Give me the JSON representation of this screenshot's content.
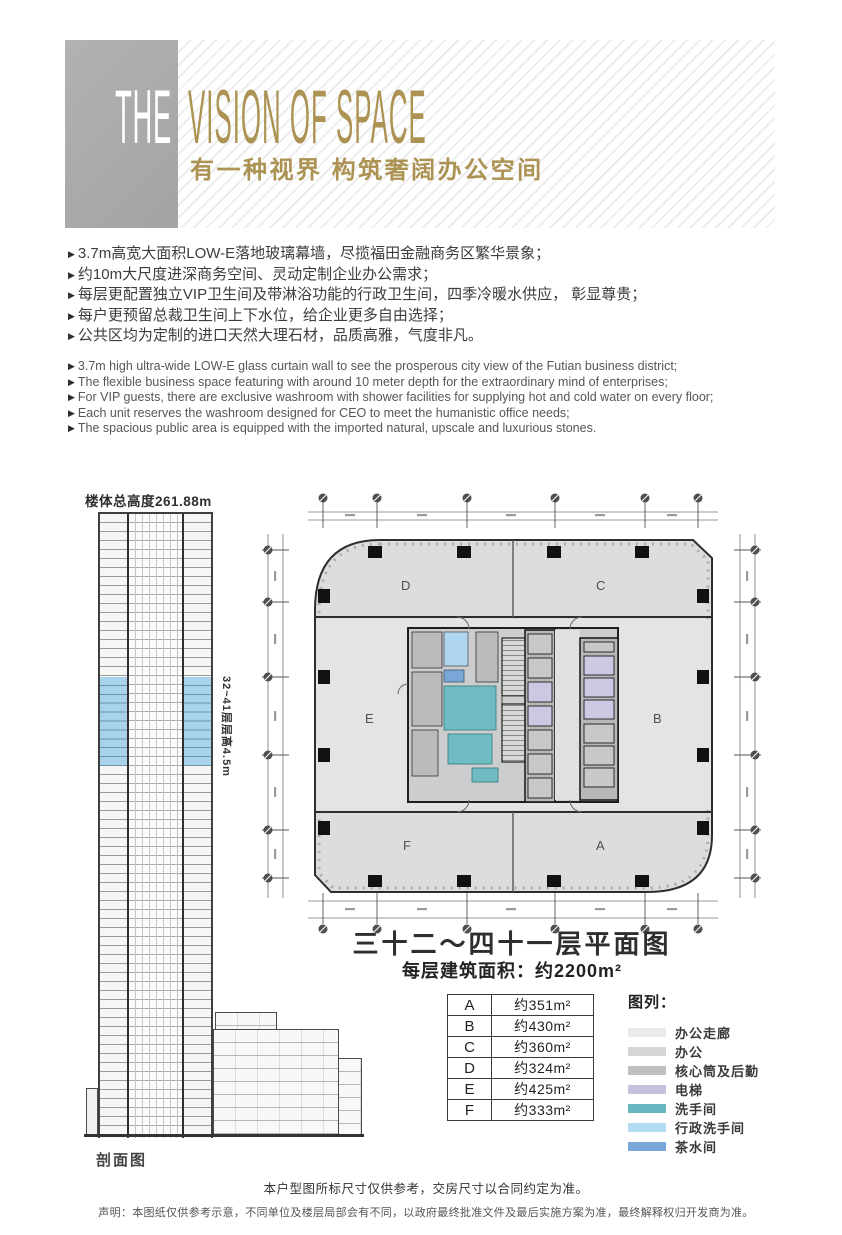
{
  "header": {
    "word_the": "THE",
    "title_en": "VISION OF SPACE",
    "subtitle_cn": "有一种视界 构筑奢阔办公空间",
    "gold_color": "#ac9353"
  },
  "bullets": {
    "glyph": "▶"
  },
  "features_cn": [
    "3.7m高宽大面积LOW-E落地玻璃幕墙，尽揽福田金融商务区繁华景象；",
    "约10m大尺度进深商务空间、灵动定制企业办公需求；",
    "每层更配置独立VIP卫生间及带淋浴功能的行政卫生间，四季冷暖水供应， 彰显尊贵；",
    "每户更预留总裁卫生间上下水位，给企业更多自由选择；",
    "公共区均为定制的进口天然大理石材，品质高雅，气度非凡。"
  ],
  "features_en": [
    "3.7m high ultra-wide LOW-E glass curtain wall to see the prosperous city view of the Futian business district;",
    "The flexible business space featuring with around 10 meter depth for the extraordinary mind of enterprises;",
    "For VIP guests, there are exclusive washroom with shower facilities for supplying hot and cold water on every floor;",
    "Each unit reserves the washroom designed for CEO to meet the humanistic office needs;",
    "The spacious public area is equipped with the imported natural, upscale and luxurious stones."
  ],
  "section_view": {
    "total_height_label": "楼体总高度261.88m",
    "floors_note": "32~41层层高4.5m",
    "caption": "剖面图",
    "highlight_color": "#a9d2ec"
  },
  "floor_plan": {
    "title": "三十二～四十一层平面图",
    "area_per_floor": "每层建筑面积：约2200m²",
    "zone_labels": {
      "A": "A",
      "B": "B",
      "C": "C",
      "D": "D",
      "E": "E",
      "F": "F"
    }
  },
  "area_table": {
    "rows": [
      {
        "zone": "A",
        "area": "约351m²"
      },
      {
        "zone": "B",
        "area": "约430m²"
      },
      {
        "zone": "C",
        "area": "约360m²"
      },
      {
        "zone": "D",
        "area": "约324m²"
      },
      {
        "zone": "E",
        "area": "约425m²"
      },
      {
        "zone": "F",
        "area": "约333m²"
      }
    ]
  },
  "legend": {
    "title": "图列：",
    "items": [
      {
        "label": "办公走廊",
        "color": "#e9ebec"
      },
      {
        "label": "办公",
        "color": "#d3d5d6"
      },
      {
        "label": "核心筒及后勤",
        "color": "#bdbfc1"
      },
      {
        "label": "电梯",
        "color": "#c4c1de"
      },
      {
        "label": "洗手间",
        "color": "#66b7bf"
      },
      {
        "label": "行政洗手间",
        "color": "#b3dcf2"
      },
      {
        "label": "茶水间",
        "color": "#7aa7d9"
      }
    ]
  },
  "footer": {
    "line1": "本户型图所标尺寸仅供参考，交房尺寸以合同约定为准。",
    "line2": "声明：本图纸仅供参考示意，不同单位及楼层局部会有不同，以政府最终批准文件及最后实施方案为准，最终解释权归开发商为准。"
  }
}
